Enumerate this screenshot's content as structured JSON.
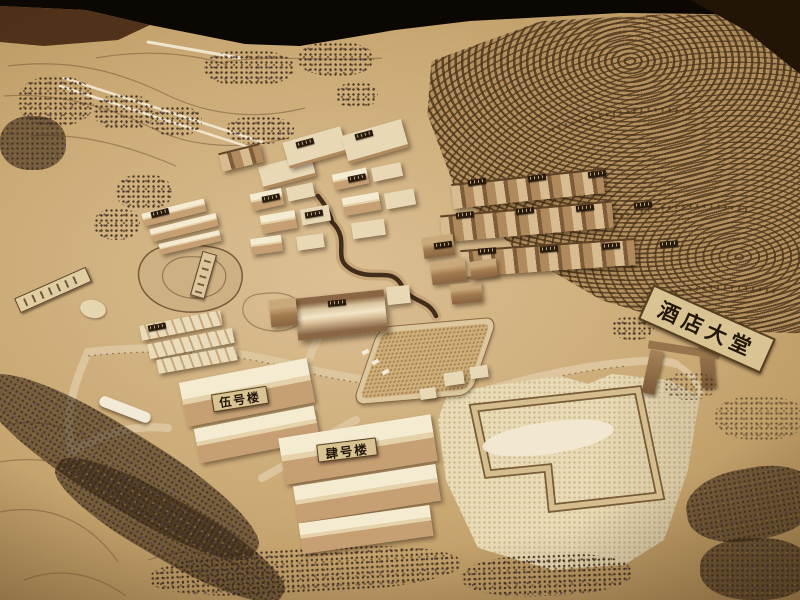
{
  "scene": {
    "subject": "Wooden architectural scale model of a hillside hotel resort development, photographed at an oblique angle on a dark table",
    "placards": {
      "hotel_lobby": "酒店大堂",
      "building_no5": "伍号楼",
      "building_no4": "肆号楼"
    },
    "palette": {
      "background_table": "#0b0703",
      "wood_floor": "#503119",
      "ground_tan": "#c9a873",
      "plaza_light": "#e9dbb5",
      "terrace_dark": "#5e4528",
      "terrace_light": "#b3905e",
      "building_light": "#ecdfc2",
      "building_brown": "#9a7850",
      "placard_bg": "#d9c393",
      "placard_text": "#221709"
    }
  }
}
